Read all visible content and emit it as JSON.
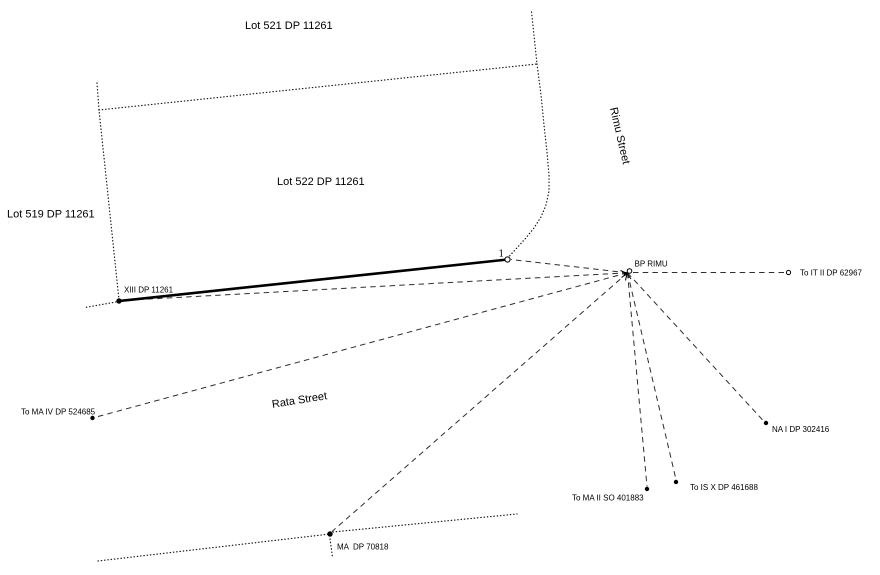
{
  "canvas": {
    "width": 880,
    "height": 575,
    "background": "#ffffff",
    "ink": "#000000"
  },
  "plan": {
    "lot_labels": [
      "Lot 521 DP 11261",
      "Lot 522 DP 11261",
      "Lot 519 DP 11261"
    ],
    "street_labels": [
      "Rimu Street",
      "Rata Street"
    ],
    "survey_marks": [
      "BP RIMU",
      "XIII DP 11261",
      "1",
      "To IT II DP 62967",
      "To MA IV DP 524685",
      "NA I DP 302416",
      "To IS X DP 461688",
      "To MA II SO 401883",
      "MA  DP 70818"
    ]
  },
  "labels": [
    {
      "name": "label-lot-521",
      "text": "Lot 521 DP 11261",
      "x": 245,
      "y": 29,
      "size": 11,
      "rotate": 0,
      "anchor": "start"
    },
    {
      "name": "label-lot-522",
      "text": "Lot 522 DP 11261",
      "x": 277,
      "y": 185,
      "size": 11,
      "rotate": 0,
      "anchor": "start"
    },
    {
      "name": "label-lot-519",
      "text": "Lot 519 DP 11261",
      "x": 7,
      "y": 217.5,
      "size": 11,
      "rotate": 0,
      "anchor": "start"
    },
    {
      "name": "label-rimu-street",
      "text": "Rimu Street",
      "x": 616.5,
      "y": 136.5,
      "size": 11,
      "rotate": 77,
      "anchor": "middle"
    },
    {
      "name": "label-rata-street",
      "text": "Rata Street",
      "x": 300,
      "y": 403.5,
      "size": 11,
      "rotate": -9,
      "anchor": "middle"
    },
    {
      "name": "label-bp-rimu",
      "text": "BP RIMU",
      "x": 634.5,
      "y": 266.5,
      "size": 8,
      "rotate": 0,
      "anchor": "start"
    },
    {
      "name": "label-node-1",
      "text": "1",
      "x": 498.5,
      "y": 256.5,
      "size": 9,
      "rotate": 0,
      "anchor": "start",
      "serif": true
    },
    {
      "name": "label-xiii",
      "text": "XIII DP 11261",
      "x": 124,
      "y": 292.5,
      "size": 8,
      "rotate": 0,
      "anchor": "start"
    },
    {
      "name": "label-to-it-ii",
      "text": "To IT II DP 62967",
      "x": 800,
      "y": 275.5,
      "size": 8,
      "rotate": 0,
      "anchor": "start"
    },
    {
      "name": "label-to-ma-iv",
      "text": "To MA IV DP 524685",
      "x": 21,
      "y": 414.5,
      "size": 8,
      "rotate": 0,
      "anchor": "start"
    },
    {
      "name": "label-na-i",
      "text": "NA I DP 302416",
      "x": 772,
      "y": 432,
      "size": 8,
      "rotate": 0,
      "anchor": "start"
    },
    {
      "name": "label-to-is-x",
      "text": "To IS X DP 461688",
      "x": 690,
      "y": 490,
      "size": 8,
      "rotate": 0,
      "anchor": "start"
    },
    {
      "name": "label-to-ma-ii",
      "text": "To MA II SO 401883",
      "x": 572,
      "y": 500.5,
      "size": 8,
      "rotate": 0,
      "anchor": "start"
    },
    {
      "name": "label-ma-dp",
      "text": "MA  DP 70818",
      "x": 337,
      "y": 549.5,
      "size": 8,
      "rotate": 0,
      "anchor": "start"
    }
  ],
  "dotted_lines": [
    {
      "name": "boundary-lot522-west",
      "points": [
        [
          97,
          83
        ],
        [
          99,
          110
        ],
        [
          119,
          300
        ]
      ]
    },
    {
      "name": "boundary-stub-southwest",
      "points": [
        [
          116,
          302
        ],
        [
          85,
          307.5
        ]
      ]
    },
    {
      "name": "boundary-lot522-north",
      "points": [
        [
          99,
          110
        ],
        [
          537,
          64
        ]
      ]
    },
    {
      "name": "boundary-rimu-street-north",
      "points": [
        [
          531.5,
          12
        ],
        [
          537,
          64
        ]
      ]
    },
    {
      "name": "boundary-lot522-east-curve",
      "points": [
        [
          537,
          64
        ],
        [
          541,
          95
        ],
        [
          544,
          125
        ],
        [
          547,
          152
        ],
        [
          549,
          175
        ],
        [
          549,
          191
        ],
        [
          546,
          205
        ],
        [
          541,
          217
        ],
        [
          534,
          228
        ],
        [
          525,
          239
        ],
        [
          515,
          250
        ],
        [
          509.5,
          256
        ]
      ]
    },
    {
      "name": "street-line-southwest",
      "points": [
        [
          98,
          561
        ],
        [
          330,
          534
        ]
      ]
    },
    {
      "name": "street-line-southeast",
      "points": [
        [
          333,
          532
        ],
        [
          517,
          514
        ]
      ]
    },
    {
      "name": "tick-below-ma-mark",
      "points": [
        [
          330,
          539
        ],
        [
          332.5,
          557
        ]
      ]
    }
  ],
  "dashed_rays": [
    {
      "name": "ray-bp-to-node-1",
      "from": [
        627.5,
        272.8
      ],
      "to": [
        511,
        259.5
      ]
    },
    {
      "name": "ray-bp-to-xiii",
      "from": [
        627.5,
        272.8
      ],
      "to": [
        122,
        300.5
      ]
    },
    {
      "name": "ray-bp-to-ma-iv",
      "from": [
        627.5,
        272.8
      ],
      "to": [
        95.5,
        417.2
      ]
    },
    {
      "name": "ray-bp-to-ma",
      "from": [
        627.5,
        272.8
      ],
      "to": [
        332,
        531.5
      ]
    },
    {
      "name": "ray-bp-to-ma-ii",
      "from": [
        627.5,
        272.8
      ],
      "to": [
        647,
        486.5
      ]
    },
    {
      "name": "ray-bp-to-is-x",
      "from": [
        627.5,
        272.8
      ],
      "to": [
        676,
        479.5
      ]
    },
    {
      "name": "ray-bp-to-na-i",
      "from": [
        627.5,
        272.8
      ],
      "to": [
        764,
        421.5
      ]
    },
    {
      "name": "ray-bp-to-it-ii",
      "from": [
        633,
        272.5
      ],
      "to": [
        785.5,
        272.5
      ]
    }
  ],
  "solid_lines": [
    {
      "name": "traverse-line-1-to-xiii",
      "points": [
        [
          507.5,
          259.5
        ],
        [
          119,
          301
        ]
      ]
    }
  ],
  "marks": [
    {
      "name": "mark-xiii",
      "type": "filled",
      "x": 119,
      "y": 301,
      "r": 2.7
    },
    {
      "name": "mark-ma-iv",
      "type": "filled",
      "x": 92.5,
      "y": 418,
      "r": 2.2
    },
    {
      "name": "mark-ma",
      "type": "filled",
      "x": 330,
      "y": 534,
      "r": 2.7
    },
    {
      "name": "mark-ma-ii",
      "type": "filled",
      "x": 647,
      "y": 489,
      "r": 2.2
    },
    {
      "name": "mark-is-x",
      "type": "filled",
      "x": 676,
      "y": 482,
      "r": 2.2
    },
    {
      "name": "mark-na-i",
      "type": "filled",
      "x": 766,
      "y": 423,
      "r": 2.2
    },
    {
      "name": "mark-node-1",
      "type": "open",
      "x": 507.5,
      "y": 259.5,
      "r": 2.6
    },
    {
      "name": "mark-it-ii",
      "type": "open",
      "x": 788.5,
      "y": 272.5,
      "r": 2.1
    }
  ],
  "beacon": {
    "name": "mark-bp-rimu",
    "x": 627,
    "y": 273.5,
    "legs": [
      [
        620.5,
        270.5
      ],
      [
        621.5,
        277.5
      ],
      [
        625.5,
        280.5
      ],
      [
        631,
        279
      ]
    ],
    "circle": {
      "x": 629.5,
      "y": 271,
      "r": 2.3
    },
    "dot": {
      "x": 625.5,
      "y": 273.8,
      "r": 1.7
    }
  }
}
